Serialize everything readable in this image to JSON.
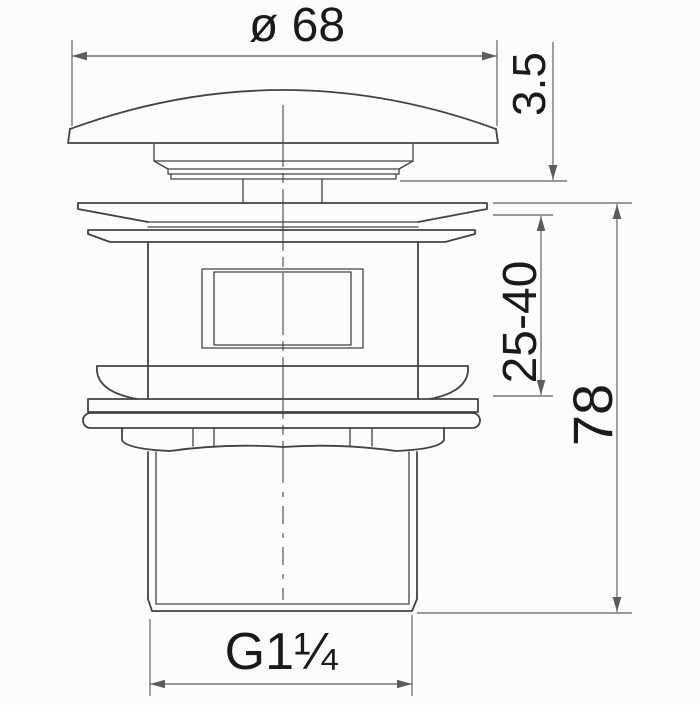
{
  "drawing": {
    "kind": "technical-dimension-drawing",
    "dimensions": {
      "diameter_label": "ø 68",
      "cap_gap_label": "3.5",
      "clamping_range_label": "25-40",
      "total_height_label": "78",
      "thread_label": "G1¼"
    },
    "colors": {
      "line": "#424242",
      "dim": "#5c5c5c",
      "text": "#1a1a1a",
      "bg": "#fcfcfc"
    }
  }
}
